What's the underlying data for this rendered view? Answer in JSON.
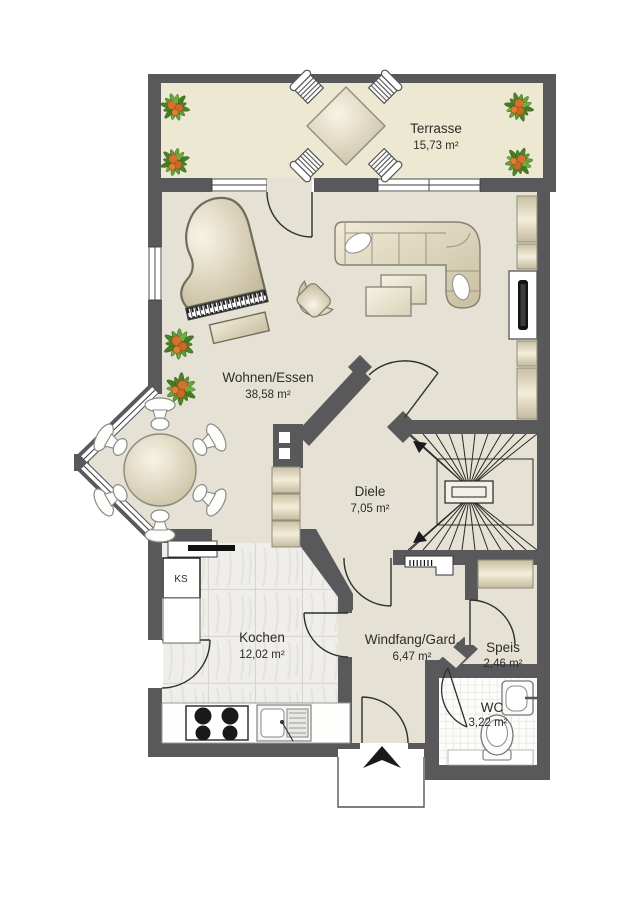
{
  "plan": {
    "rooms": [
      {
        "id": "terrasse",
        "name": "Terrasse",
        "area": "15,73 m²"
      },
      {
        "id": "wohnen-essen",
        "name": "Wohnen/Essen",
        "area": "38,58 m²"
      },
      {
        "id": "diele",
        "name": "Diele",
        "area": "7,05 m²"
      },
      {
        "id": "kochen",
        "name": "Kochen",
        "area": "12,02 m²"
      },
      {
        "id": "windfang-gard",
        "name": "Windfang/Gard.",
        "area": "6,47 m²"
      },
      {
        "id": "speis",
        "name": "Speis",
        "area": "2,46 m²"
      },
      {
        "id": "wc",
        "name": "WC",
        "area": "3,22 m²"
      }
    ],
    "appliance_labels": {
      "fridge": "KS"
    },
    "colors": {
      "wall": "#59595b",
      "terrace_floor": "#ece8d2",
      "interior_floor": "#e5e1d4",
      "kitchen_tile": "#efeeea",
      "wc_tile": "#fcfcfa",
      "furniture_light": "#f8f4e6",
      "furniture_dark": "#c6bc9e",
      "plant_green": "#4c8226",
      "plant_orange": "#d2722c"
    }
  }
}
